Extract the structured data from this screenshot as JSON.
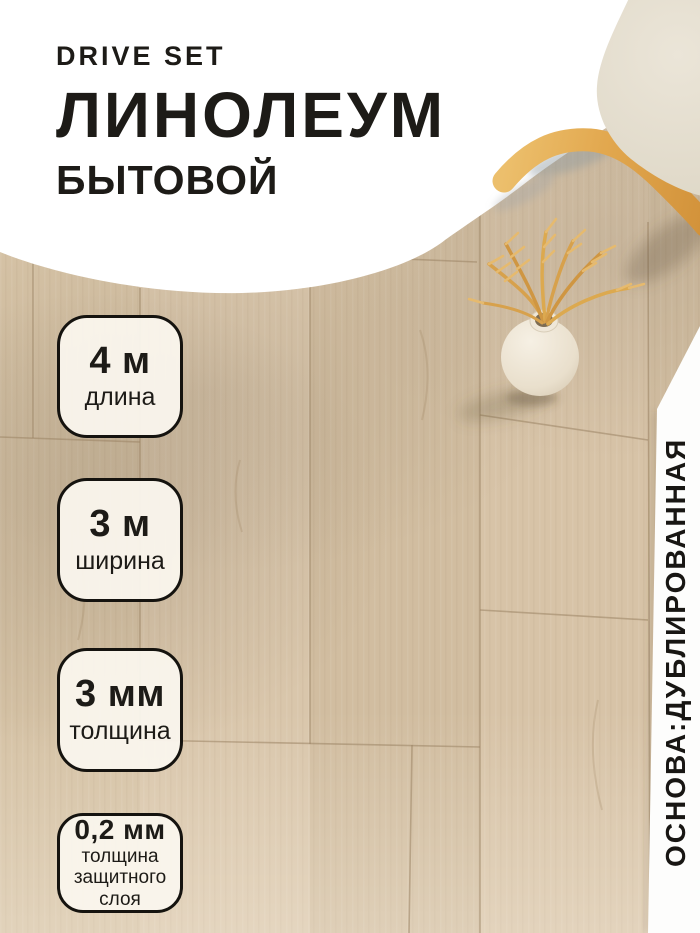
{
  "header": {
    "brand": "DRIVE SET",
    "title": "ЛИНОЛЕУМ",
    "subtitle": "БЫТОВОЙ"
  },
  "badges": [
    {
      "value": "4 м",
      "label": "длина"
    },
    {
      "value": "3 м",
      "label": "ширина"
    },
    {
      "value": "3 мм",
      "label": "толщина"
    },
    {
      "value": "0,2 мм",
      "label": "толщина защитного слоя"
    }
  ],
  "side_label": {
    "text": "ОСНОВА:ДУБЛИРОВАННАЯ"
  },
  "decor": {
    "floor": "wood-plank-linoleum-floor",
    "chair": "chair-with-wooden-legs",
    "vase": "white-vase-with-dried-wheat"
  },
  "colors": {
    "text": "#1d1b17",
    "header_bg": "#ffffff",
    "badge_bg": "#f8f3ea",
    "badge_border": "#15130f",
    "wood_base": "#d4c0a3",
    "chair_wood": "#e0a64c",
    "wheat": "#d7a14c"
  }
}
